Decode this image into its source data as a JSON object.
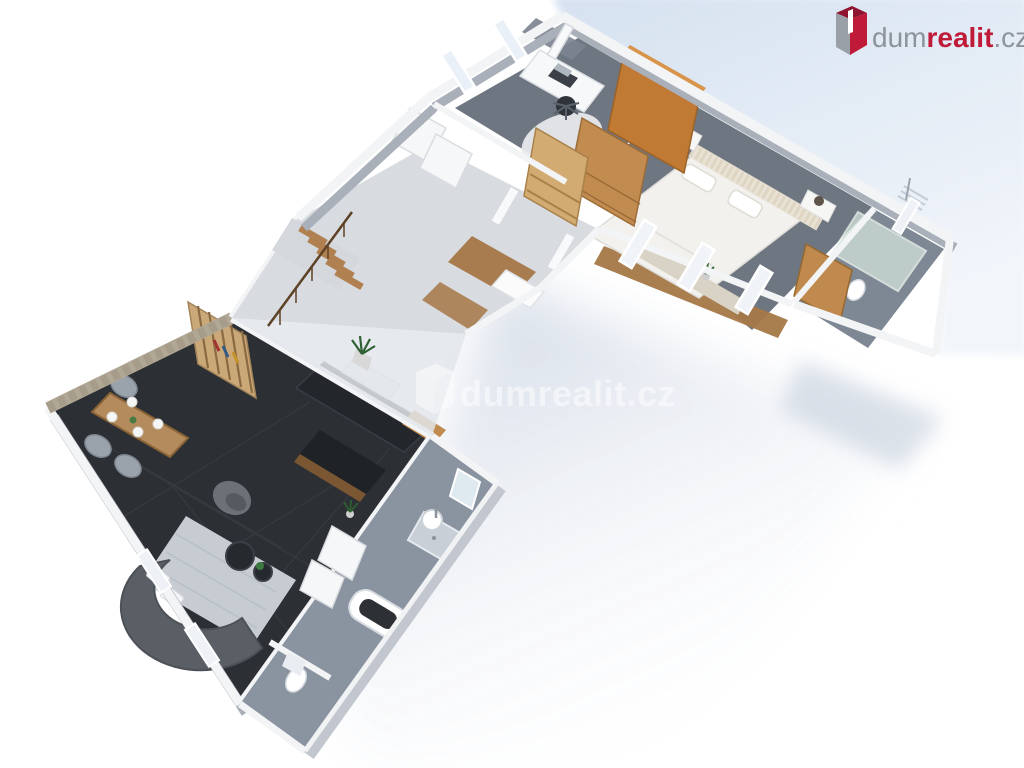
{
  "brand": {
    "logo_prefix": "dum",
    "logo_highlight": "realit",
    "logo_suffix": ".cz"
  },
  "watermark": {
    "text": "dumrealit.cz",
    "opacity": "0.5"
  },
  "colors": {
    "brand_red": "#bf1a38",
    "brand_grey": "#8d929b",
    "logo_box_grey": "#9aa0a8",
    "logo_box_dark_red": "#8f1430",
    "sky": "#d9e4f1",
    "shadow": "#c7d1e0",
    "wall_top": "#f3f4f6",
    "wall_side": "#aab0ba",
    "floor_hall": "#d8dbe0",
    "floor_grey": "#6e7681",
    "floor_bath": "#7e8894",
    "floor_bath_lower": "#8a93a0",
    "floor_living": "#2c2f33",
    "wood": "#c08a4e",
    "wood_floor": "#a97c50",
    "stone": "#b1a795",
    "watermark_white": "#ffffff"
  },
  "scene": {
    "type": "isometric-3d-floor-plan",
    "rooms": [
      {
        "name": "study",
        "items": [
          "desk",
          "laptop",
          "office-chair",
          "round-rug",
          "windows"
        ]
      },
      {
        "name": "bedroom",
        "items": [
          "double-bed",
          "striped-headboard",
          "nightstand-left",
          "nightstand-right",
          "table-lamps",
          "wardrobe",
          "chest-of-drawers",
          "shelf-unit",
          "windows",
          "potted-plant"
        ]
      },
      {
        "name": "ensuite-bathroom",
        "items": [
          "glass-shower",
          "toilet",
          "bidet",
          "wooden-cabinet",
          "towel-radiator",
          "window"
        ]
      },
      {
        "name": "hallway",
        "items": [
          "staircase",
          "wood-railing",
          "built-in-closets",
          "console-table",
          "potted-plant",
          "entry-door",
          "wood-floor"
        ]
      },
      {
        "name": "living-dining-room",
        "items": [
          "curved-sofa",
          "white-cushions",
          "area-rug",
          "coffee-tables",
          "armchair",
          "dining-table",
          "dining-chairs",
          "plates",
          "stone-accent-wall",
          "slatted-shelf",
          "windows",
          "potted-plant"
        ]
      },
      {
        "name": "kitchen",
        "items": [
          "dark-counter",
          "island",
          "cooker-hood",
          "wood-shelf"
        ]
      },
      {
        "name": "main-bathroom",
        "items": [
          "bathtub",
          "washbasin",
          "vanity-panels",
          "mirror",
          "shower-tray",
          "door"
        ]
      },
      {
        "name": "wc",
        "items": [
          "toilet"
        ]
      }
    ]
  }
}
